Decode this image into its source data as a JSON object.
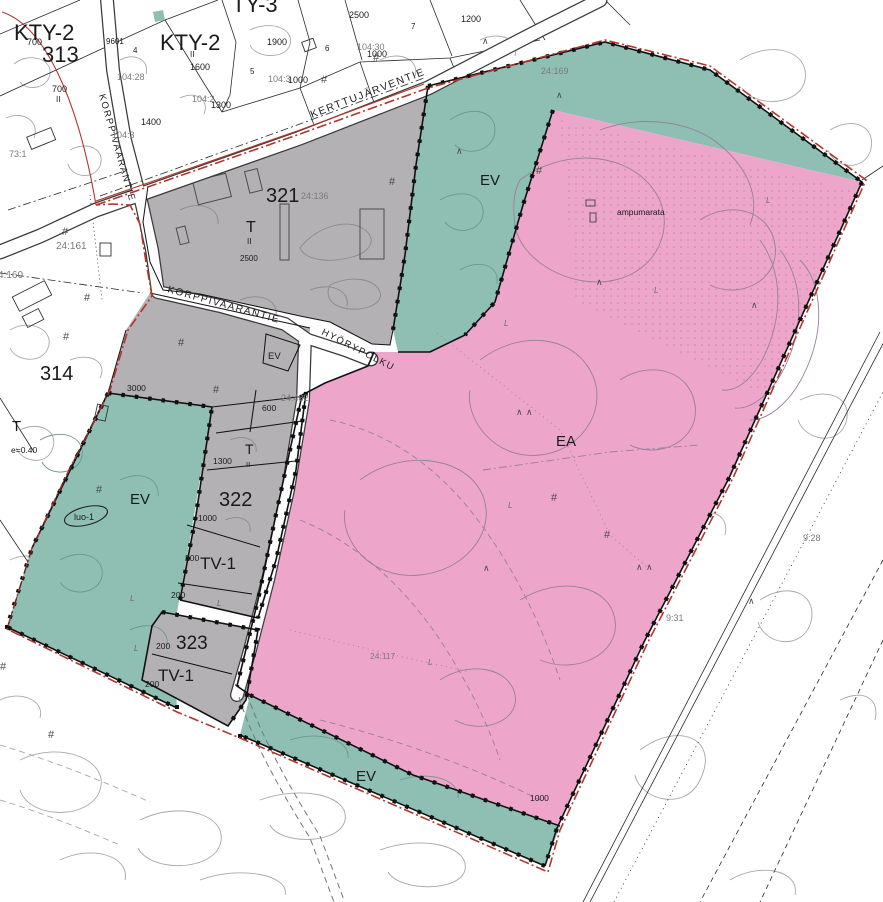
{
  "colors": {
    "ea_pink": "#eda6ca",
    "ev_teal": "#8fbfb2",
    "industry_gray": "#b4b1b4",
    "boundary_red": "#b5342c",
    "road_white": "#ffffff"
  },
  "streets": {
    "kerttujarventie": "KERTTUJÄRVENTIE",
    "korppivaarantie_north": "KORPPIVAARANTIE",
    "korppivaarantie_south": "KORPPIVAARANTIE",
    "hyorypolku": "HYÖRYPOLKU"
  },
  "zones": {
    "kty2": "KTY-2",
    "ty3": "TY-3",
    "b313": "313",
    "b314": "314",
    "b321": "321",
    "b322": "322",
    "b323": "323",
    "t": "T",
    "storeys": "II",
    "tv1": "TV-1",
    "ev": "EV",
    "ea": "EA",
    "luo1": "luo-1",
    "efficiency": "e=0.40",
    "ampumarata": "ampumarata"
  },
  "areas": {
    "a700": "700",
    "a1900": "1900",
    "a2500": "2500",
    "a1200": "1200",
    "a1600": "1600",
    "a1000": "1000",
    "a1400": "1400",
    "a1300": "1300",
    "a9601": "9601",
    "a3000": "3000",
    "a600": "600",
    "a200": "200"
  },
  "parcels": {
    "p104_28": "104:28",
    "p104_30": "104:30",
    "p104_2": "104:2",
    "p104_3": "104:3",
    "p73_1": "73:1",
    "p24_161": "24:161",
    "p4_160": "4:160",
    "p24_136": "24:136",
    "p24_169": "24:169",
    "p24_482": "24:482",
    "p24_117": "24:117",
    "p9_28": "9:28",
    "p9_31": "9:31"
  },
  "digits": {
    "d4": "4",
    "d5": "5",
    "d6": "6",
    "d7": "7"
  },
  "symbols": {
    "hash": "#",
    "tree": "∧",
    "veg": "L"
  }
}
